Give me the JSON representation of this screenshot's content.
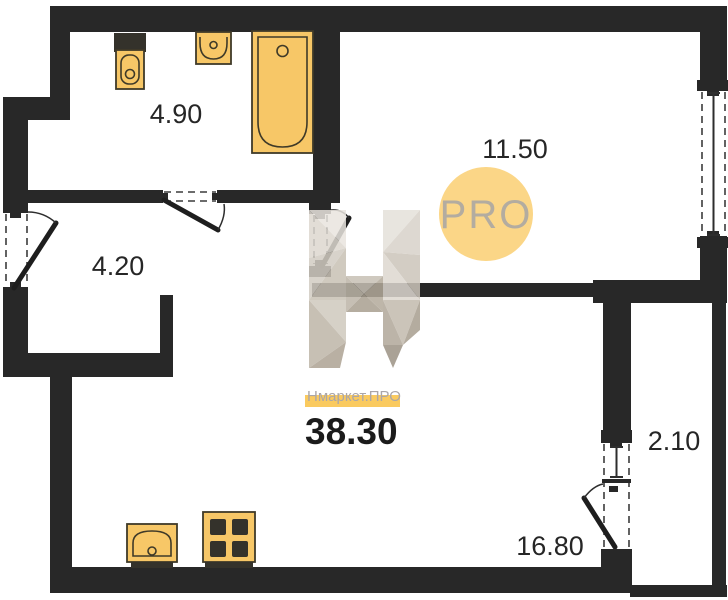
{
  "plan": {
    "type": "apartment-floor-plan",
    "total_area": "38.30",
    "brand": "Нмаркет.ПРО",
    "watermark_text": "PRO",
    "rooms": {
      "bathroom": {
        "name": "bathroom",
        "area": "4.90"
      },
      "hallway": {
        "name": "hallway",
        "area": "4.20"
      },
      "living_room": {
        "name": "living-room",
        "area": "11.50"
      },
      "kitchen_living": {
        "name": "kitchen-living",
        "area": "16.80"
      },
      "balcony": {
        "name": "balcony",
        "area": "2.10"
      }
    },
    "fixtures": [
      "toilet",
      "washbasin",
      "bathtub",
      "kitchen-sink",
      "stove"
    ],
    "openings": [
      "entrance-door",
      "bathroom-door",
      "living-room-door",
      "balcony-door",
      "living-room-window",
      "balcony-window"
    ],
    "colors": {
      "wall": "#282828",
      "fixture": "#F7C767",
      "fixture_outline": "#3F3A28",
      "fixture_dark": "#34322B",
      "watermark_circle": "#FBD687",
      "watermark_text": "#B3ACA0",
      "brand_highlight": "#F9C44E",
      "brand_text": "#ABA6A8",
      "label_text": "#262626"
    }
  }
}
